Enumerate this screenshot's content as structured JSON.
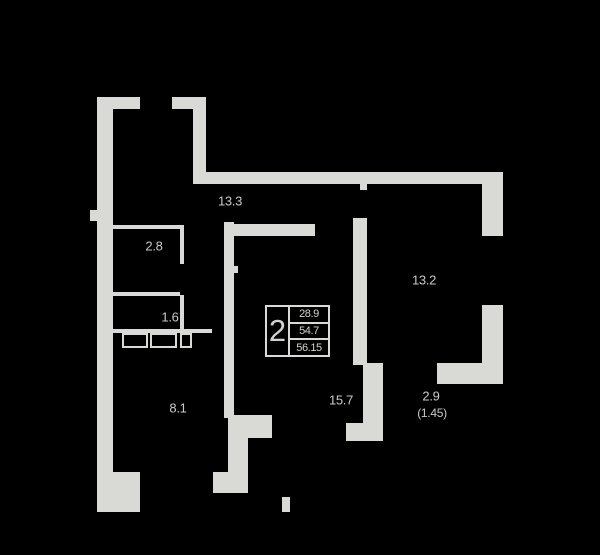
{
  "title": "apartment-floor-plan",
  "colors": {
    "background": "#000000",
    "wall": "#d9d9d6",
    "text": "#c9c9c7"
  },
  "summary_box": {
    "rooms_count": "2",
    "row1": "28.9",
    "row2": "54.7",
    "row3": "56.15"
  },
  "room_labels": [
    {
      "id": "room-13-3",
      "text": "13.3",
      "x": 230,
      "y": 201,
      "size": "normal"
    },
    {
      "id": "room-2-8",
      "text": "2.8",
      "x": 154,
      "y": 246,
      "size": "normal"
    },
    {
      "id": "room-1-6",
      "text": "1.6",
      "x": 170,
      "y": 317,
      "size": "normal"
    },
    {
      "id": "room-8-1",
      "text": "8.1",
      "x": 178,
      "y": 408,
      "size": "normal"
    },
    {
      "id": "room-13-2",
      "text": "13.2",
      "x": 424,
      "y": 280,
      "size": "normal"
    },
    {
      "id": "room-15-7",
      "text": "15.7",
      "x": 341,
      "y": 400,
      "size": "normal"
    },
    {
      "id": "balcony-2-9",
      "text": "2.9",
      "x": 431,
      "y": 396,
      "size": "normal"
    },
    {
      "id": "balcony-factor",
      "text": "(1.45)",
      "x": 432,
      "y": 413,
      "size": "small"
    }
  ],
  "walls": [
    {
      "name": "left-outer-wall",
      "x": 97,
      "y": 97,
      "w": 16,
      "h": 415
    },
    {
      "name": "top-wall-left",
      "x": 97,
      "y": 97,
      "w": 43,
      "h": 12
    },
    {
      "name": "top-wall-right",
      "x": 172,
      "y": 97,
      "w": 34,
      "h": 12
    },
    {
      "name": "entry-pier",
      "x": 193,
      "y": 97,
      "w": 13,
      "h": 87
    },
    {
      "name": "upper-corridor-wall",
      "x": 195,
      "y": 172,
      "w": 308,
      "h": 12
    },
    {
      "name": "right-wall-upper",
      "x": 482,
      "y": 172,
      "w": 21,
      "h": 64
    },
    {
      "name": "right-wall-lower",
      "x": 482,
      "y": 305,
      "w": 21,
      "h": 79
    },
    {
      "name": "room132-bottom-wall",
      "x": 437,
      "y": 363,
      "w": 66,
      "h": 21
    },
    {
      "name": "central-left-wall",
      "x": 224,
      "y": 222,
      "w": 10,
      "h": 196
    },
    {
      "name": "central-top-wall",
      "x": 224,
      "y": 224,
      "w": 91,
      "h": 12
    },
    {
      "name": "central-right-wall",
      "x": 353,
      "y": 218,
      "w": 14,
      "h": 147
    },
    {
      "name": "door-jamb-top",
      "x": 360,
      "y": 184,
      "w": 7,
      "h": 6
    },
    {
      "name": "balcony-left-wall",
      "x": 363,
      "y": 363,
      "w": 20,
      "h": 78
    },
    {
      "name": "balcony-foot-wall",
      "x": 346,
      "y": 423,
      "w": 37,
      "h": 18
    },
    {
      "name": "notch-top-wall",
      "x": 228,
      "y": 415,
      "w": 44,
      "h": 23
    },
    {
      "name": "notch-left-wall",
      "x": 228,
      "y": 438,
      "w": 20,
      "h": 55
    },
    {
      "name": "bottom-wall-chunk",
      "x": 213,
      "y": 472,
      "w": 34,
      "h": 21
    },
    {
      "name": "bottom-left-corner",
      "x": 97,
      "y": 472,
      "w": 43,
      "h": 40
    },
    {
      "name": "bottom-jamb-tick",
      "x": 282,
      "y": 497,
      "w": 8,
      "h": 15
    },
    {
      "name": "left-wall-bump",
      "x": 90,
      "y": 210,
      "w": 7,
      "h": 11
    },
    {
      "name": "door-jamb-central",
      "x": 234,
      "y": 266,
      "w": 4,
      "h": 7
    }
  ],
  "partitions": [
    {
      "name": "room28-top-wall",
      "x": 113,
      "y": 225,
      "w": 71,
      "h": 4
    },
    {
      "name": "room28-right-wall-a",
      "x": 180,
      "y": 225,
      "w": 4,
      "h": 39
    },
    {
      "name": "room28-right-wall-b",
      "x": 180,
      "y": 295,
      "w": 4,
      "h": 38
    },
    {
      "name": "room28-bottom-wall",
      "x": 113,
      "y": 292,
      "w": 67,
      "h": 4
    },
    {
      "name": "bath-bottom-wall",
      "x": 113,
      "y": 329,
      "w": 99,
      "h": 4
    }
  ],
  "fixtures": [
    {
      "name": "fixture-washer",
      "x": 122,
      "y": 333,
      "w": 26,
      "h": 15
    },
    {
      "name": "fixture-sink",
      "x": 150,
      "y": 333,
      "w": 27,
      "h": 15
    },
    {
      "name": "fixture-small",
      "x": 180,
      "y": 333,
      "w": 12,
      "h": 15
    }
  ]
}
